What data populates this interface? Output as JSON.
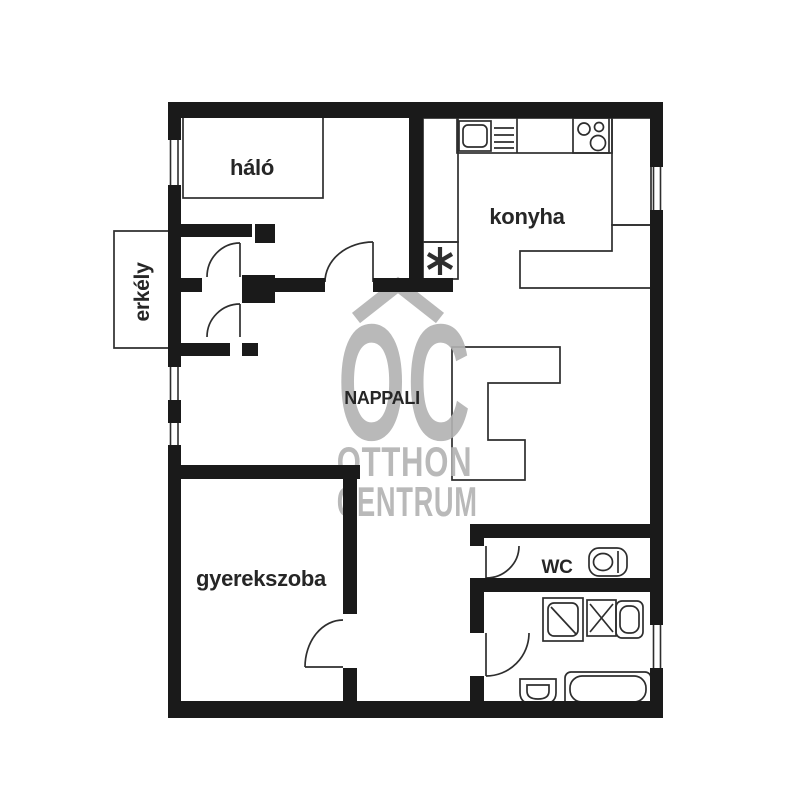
{
  "floorplan": {
    "rooms": {
      "halo": {
        "label": "háló"
      },
      "konyha": {
        "label": "konyha"
      },
      "erkely": {
        "label": "erkély"
      },
      "nappali": {
        "label": "NAPPALI"
      },
      "gyerekszoba": {
        "label": "gyerekszoba"
      },
      "wc": {
        "label": "WC"
      }
    },
    "watermark": {
      "logo": "OC",
      "line1": "OTTHON",
      "line2": "CENTRUM"
    },
    "fixtures": [
      "bed",
      "sofa-sectional",
      "kitchen-sink",
      "dish-rack",
      "stove",
      "counter",
      "asterisk-boiler",
      "toilet",
      "shower-tray",
      "washing-machine",
      "washbasin",
      "hand-basin",
      "bathtub"
    ],
    "colors": {
      "background": "#ffffff",
      "wall": "#1a1a1a",
      "line": "#2e2e2e",
      "watermark": "#b2b2b2",
      "label": "#262626"
    }
  }
}
